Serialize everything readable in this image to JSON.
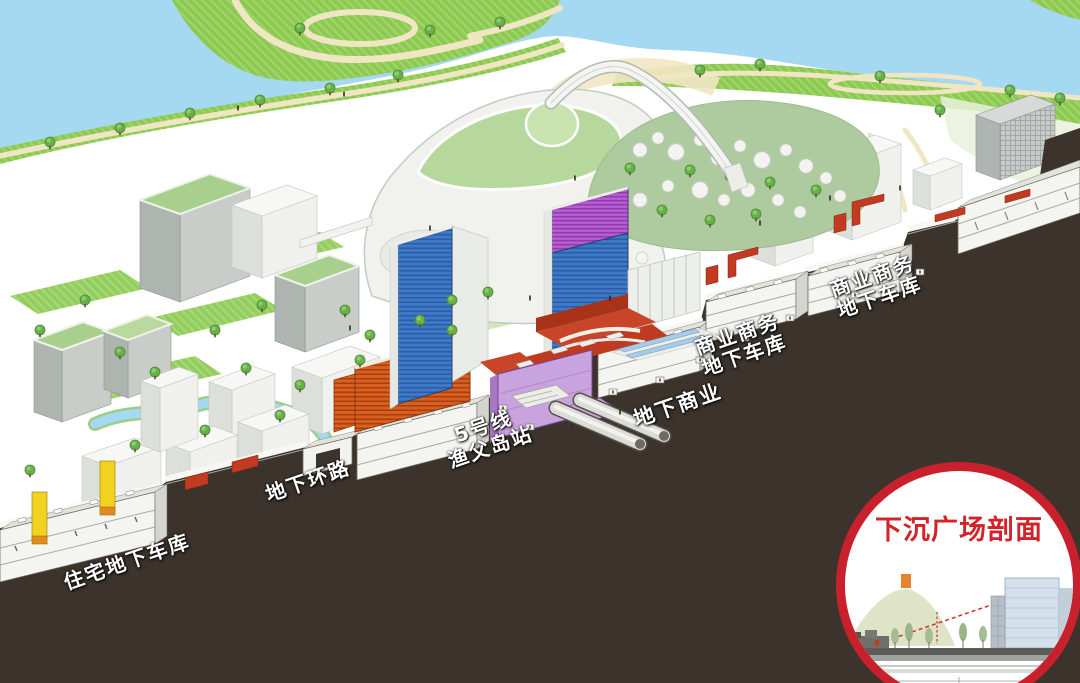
{
  "section_labels": {
    "residential_garage": {
      "lines": [
        "住宅地下车库"
      ]
    },
    "ring_road": {
      "lines": [
        "地下环路"
      ]
    },
    "metro_station": {
      "lines": [
        "5号线",
        "渔父岛站"
      ]
    },
    "underground_commercial": {
      "lines": [
        "地下商业"
      ]
    },
    "commercial_garage_a": {
      "lines": [
        "商业商务",
        "地下车库"
      ]
    },
    "commercial_garage_b": {
      "lines": [
        "商业商务",
        "地下车库"
      ]
    }
  },
  "inset": {
    "title": "下沉广场剖面"
  },
  "palette": {
    "water": "#A5D8F1",
    "park_green": "#8DC853",
    "path_beige": "#F0E6C3",
    "cut_dark": "#3B332C",
    "garage_white": "#F4F4F0",
    "tower_blue": "#3D79C6",
    "tower_violet": "#B65CD0",
    "facade_orange": "#D8601F",
    "station_purple": "#C9A3DE",
    "plaza_red": "#C8452A",
    "core_yellow": "#F2D21F",
    "inset_border_red": "#C8202C",
    "inset_title_red": "#D3232A",
    "label_text": "#FFFFFF"
  }
}
